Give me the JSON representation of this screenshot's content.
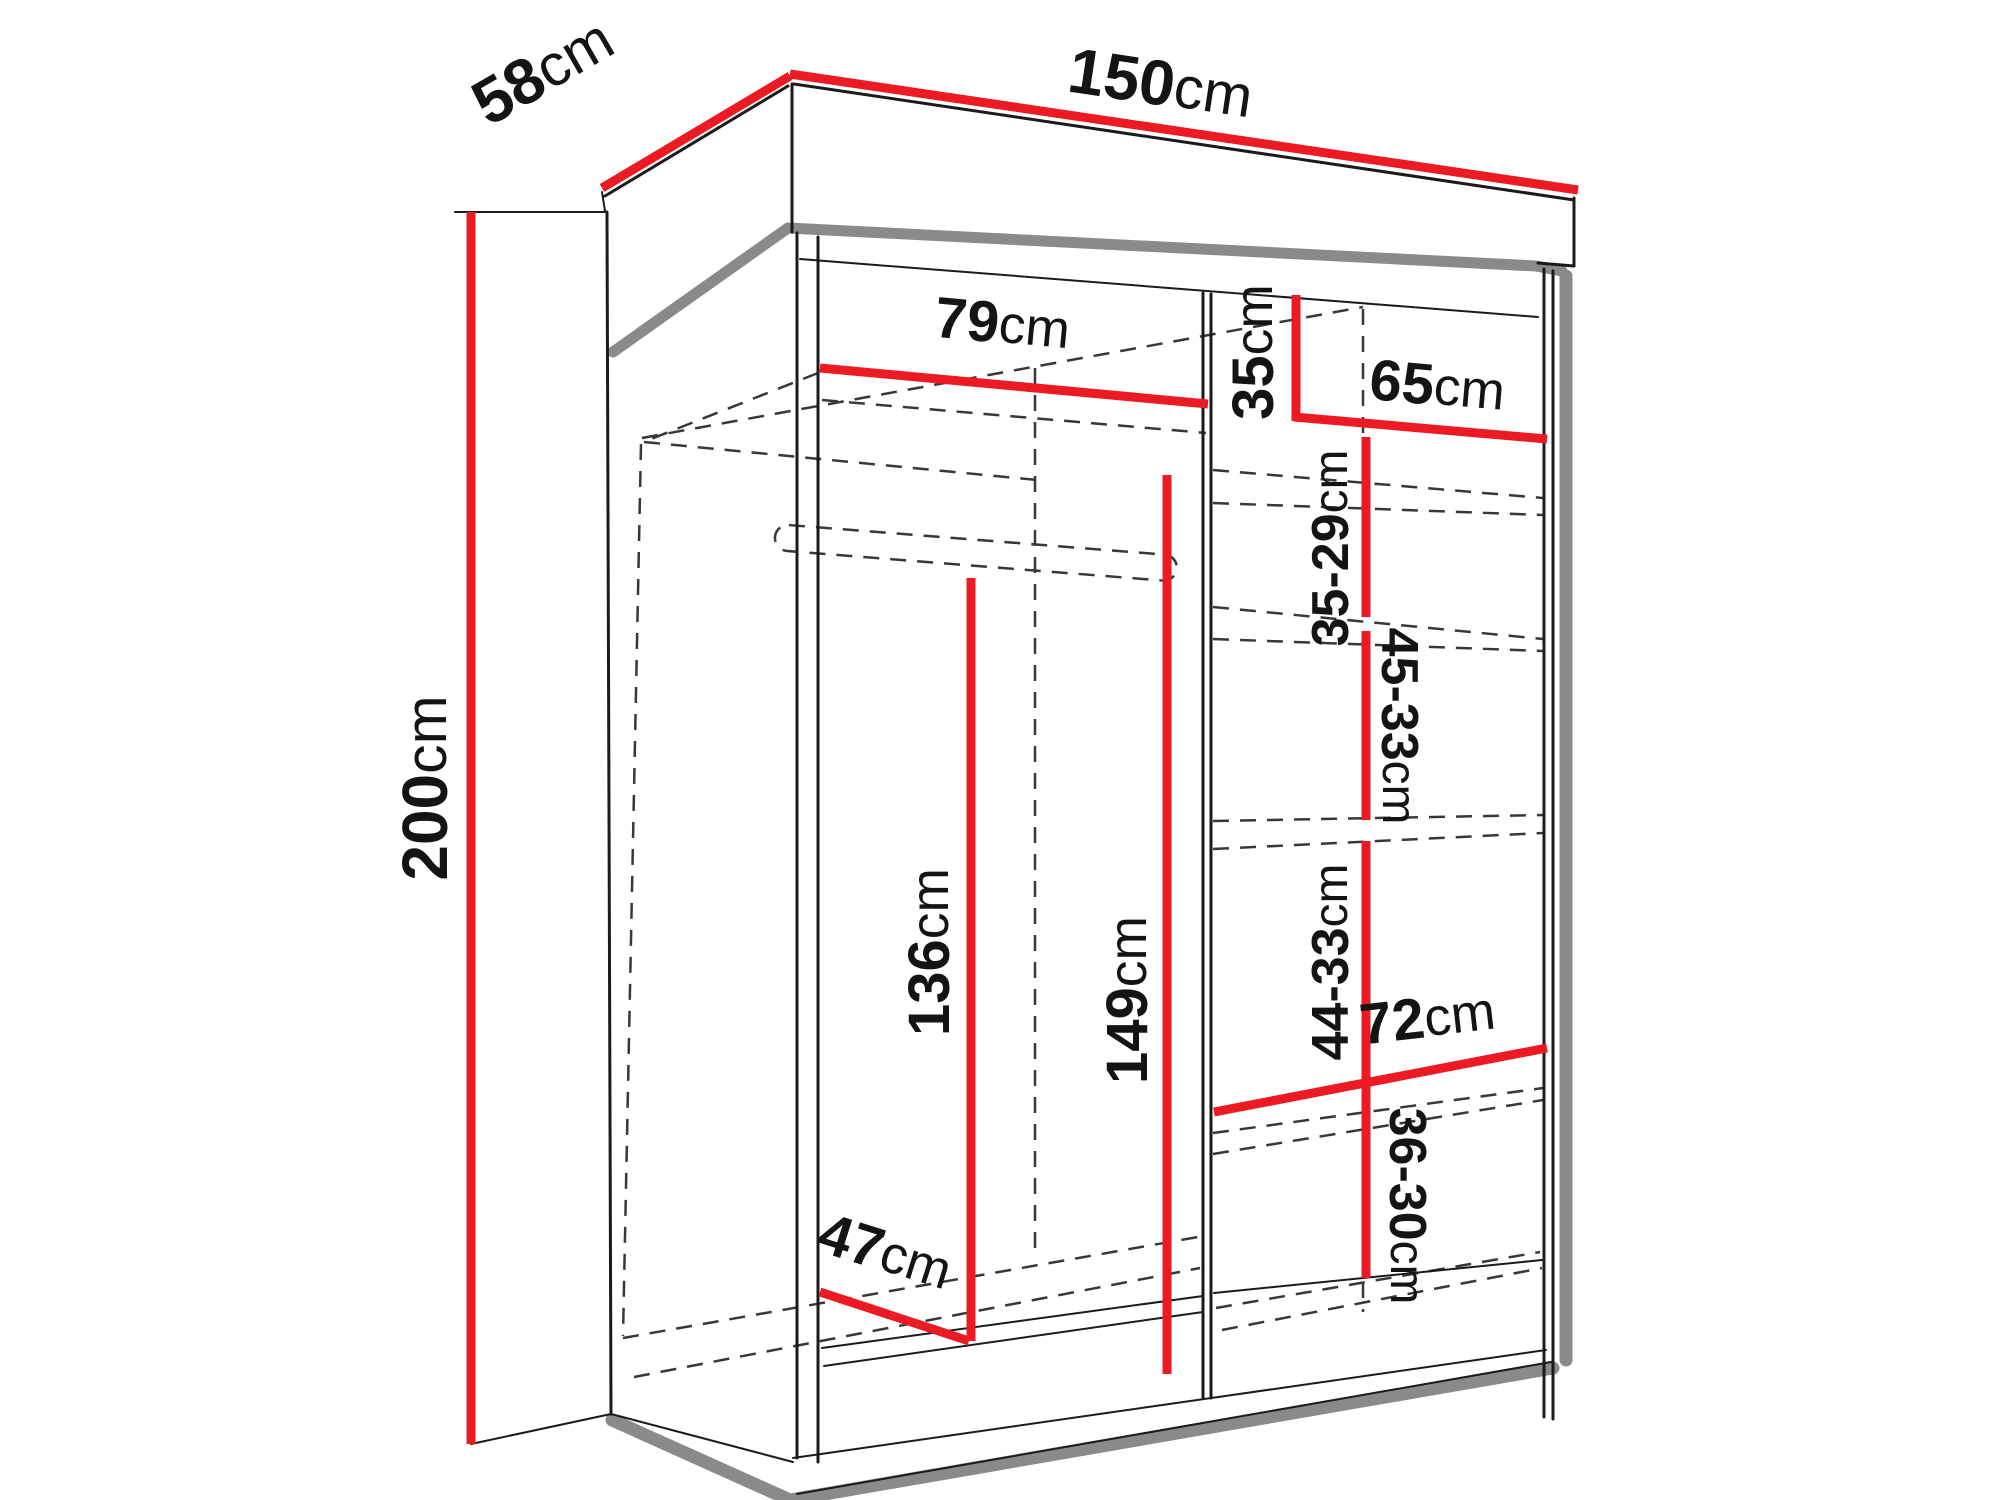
{
  "figure": {
    "kind": "wardrobe-dimension-diagram",
    "unit": "cm"
  },
  "colors": {
    "dimension_line": "#ec1b23",
    "panel_shadow_gray": "#8a8a8a",
    "edge_black": "#1b1b1b",
    "hidden_edge_dash": "#383838",
    "background": "#ffffff"
  },
  "dims": {
    "depth": {
      "value": "58",
      "unit": "cm"
    },
    "width": {
      "value": "150",
      "unit": "cm"
    },
    "height": {
      "value": "200",
      "unit": "cm"
    },
    "upper_shelf_width": {
      "value": "79",
      "unit": "cm"
    },
    "top_right_height": {
      "value": "35",
      "unit": "cm"
    },
    "right_shelf_width": {
      "value": "65",
      "unit": "cm"
    },
    "upper_right_gap": {
      "value": "35-29",
      "unit": "cm"
    },
    "mid_right_gap": {
      "value": "45-33",
      "unit": "cm"
    },
    "hanging_space_height": {
      "value": "136",
      "unit": "cm"
    },
    "left_column_height": {
      "value": "149",
      "unit": "cm"
    },
    "lower_right_gap": {
      "value": "44-33",
      "unit": "cm"
    },
    "bottom_shelf_width": {
      "value": "72",
      "unit": "cm"
    },
    "bottom_right_gap": {
      "value": "36-30",
      "unit": "cm"
    },
    "floor_depth": {
      "value": "47",
      "unit": "cm"
    }
  }
}
